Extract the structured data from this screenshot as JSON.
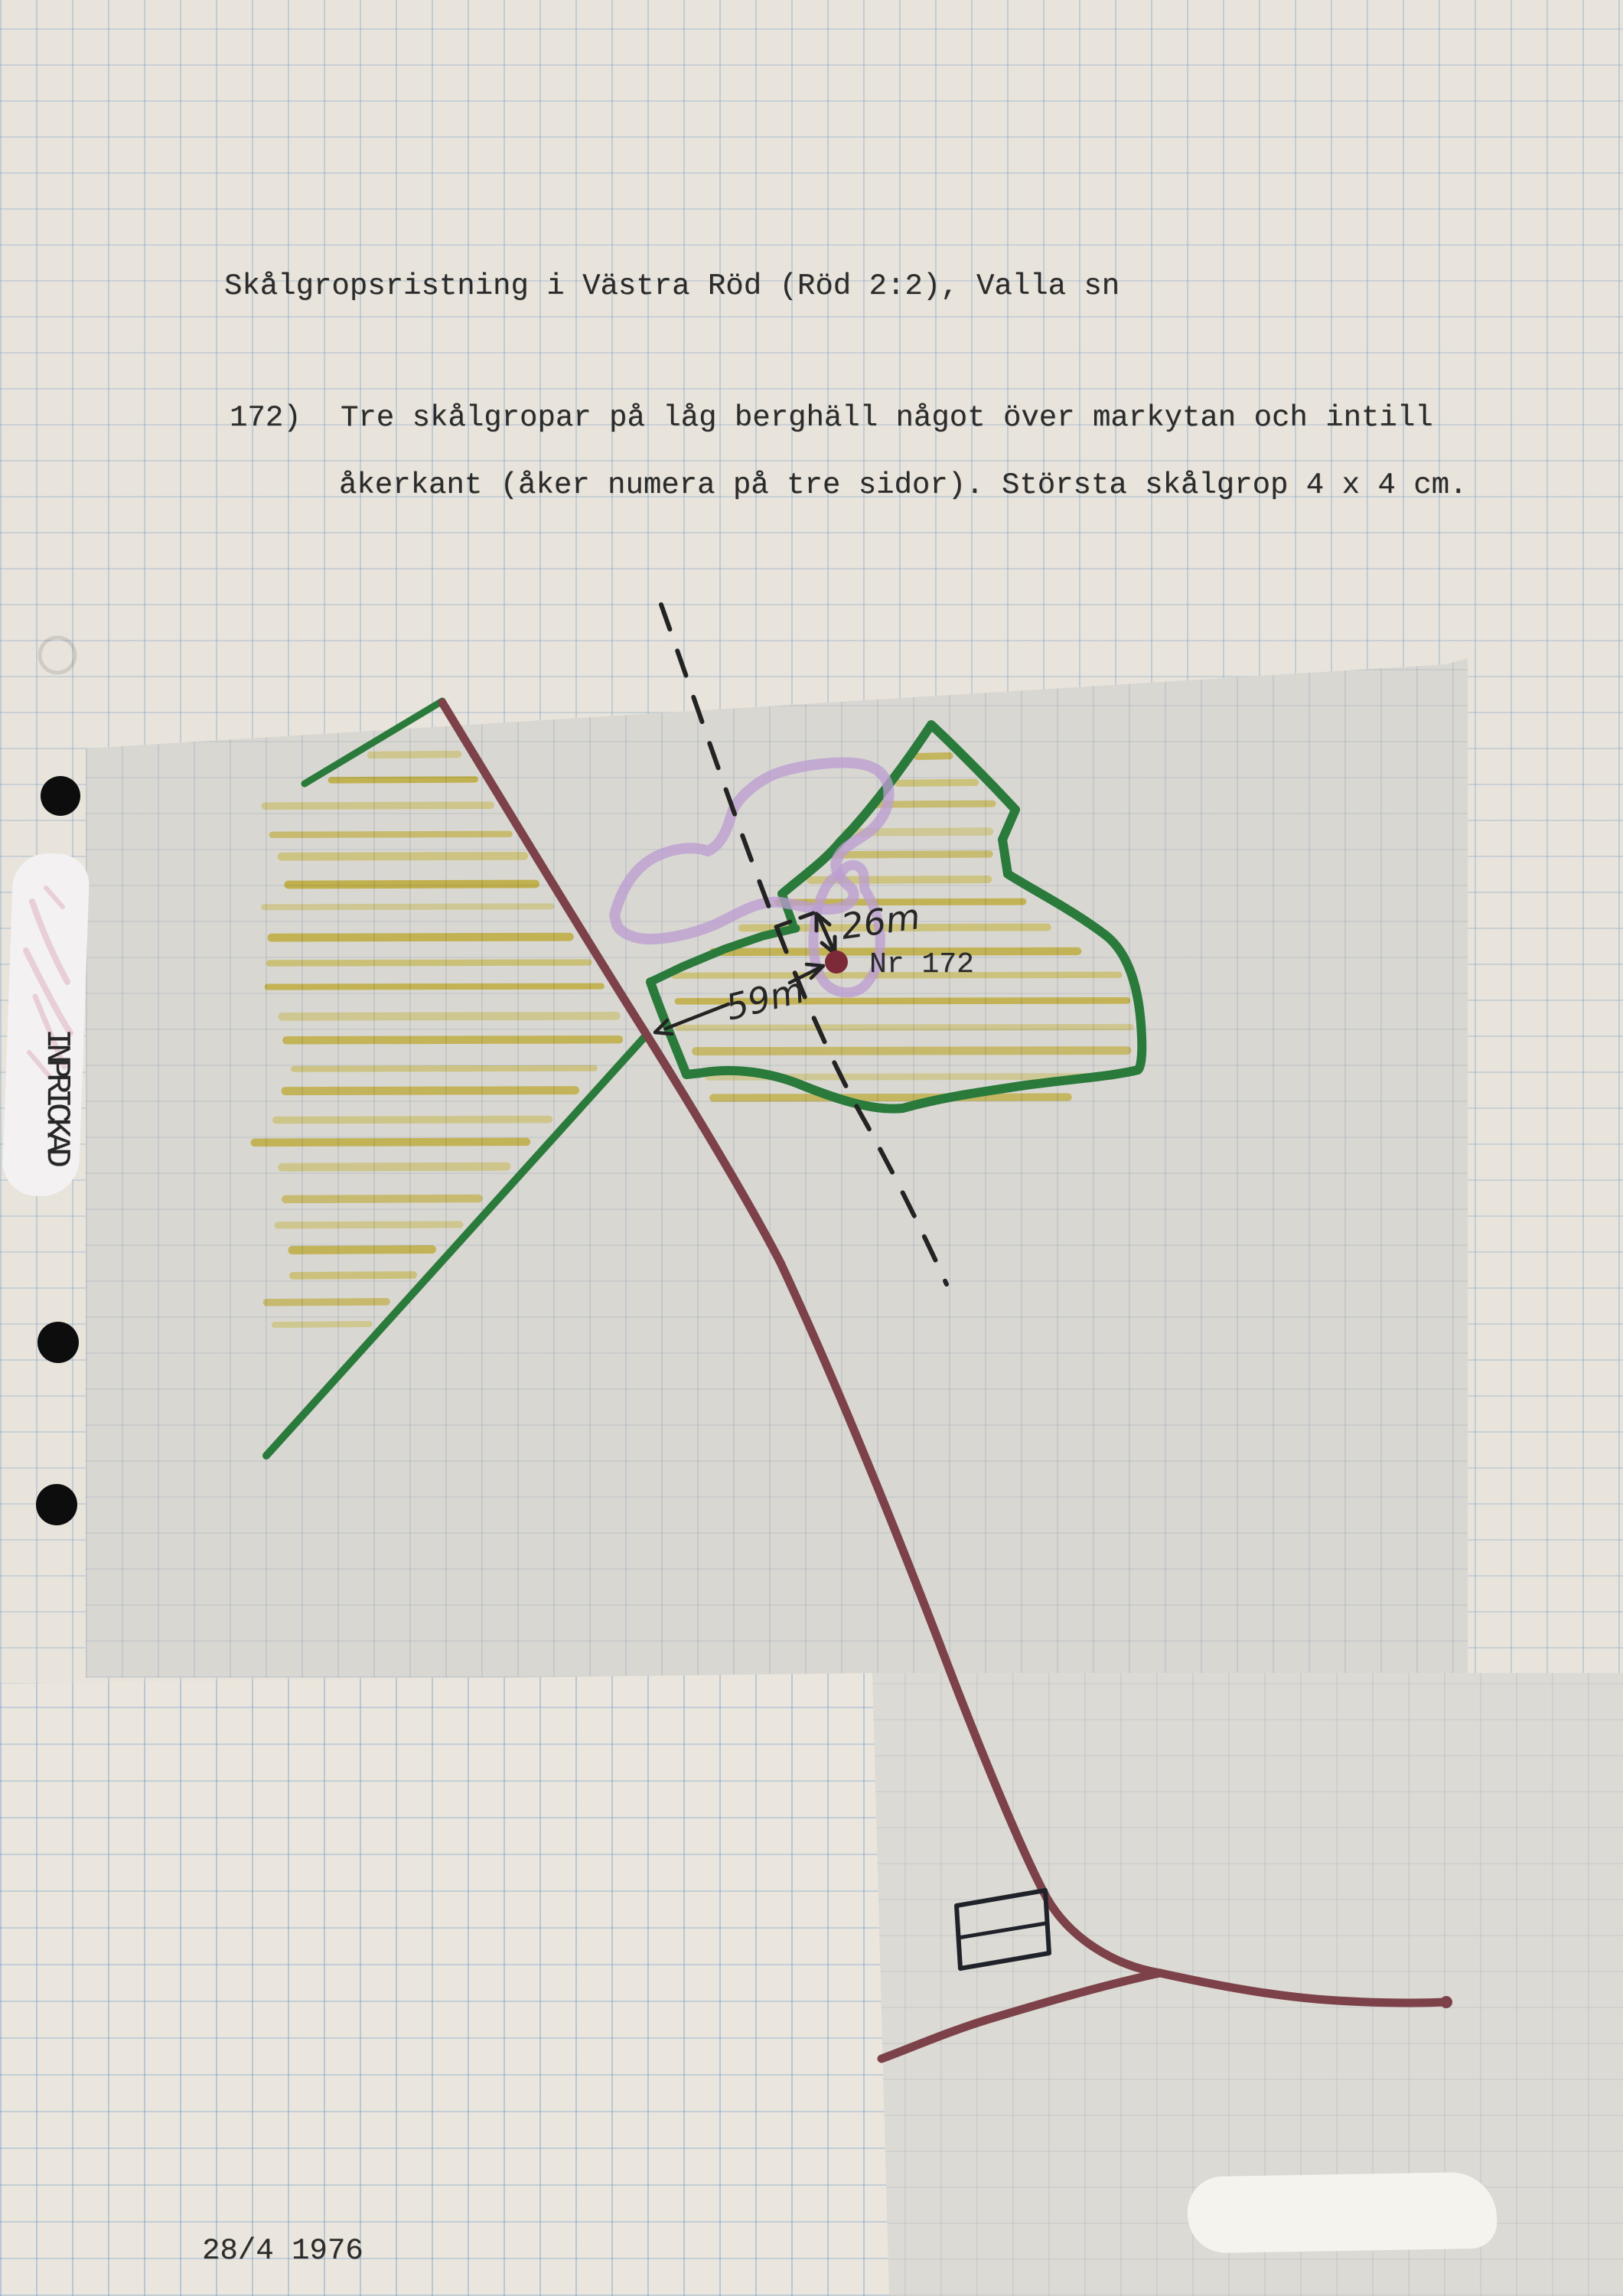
{
  "document": {
    "title": "Skålgropsristning i Västra Röd (Röd 2:2), Valla sn",
    "entry": {
      "number": "172)",
      "description_line1": "Tre skålgropar på låg berghäll något över markytan och intill",
      "description_line2": "åkerkant (åker numera på tre sidor). Största skålgrop 4 x 4 cm."
    },
    "date": "28/4 1976",
    "margin_stamp": "INPRICKAD"
  },
  "map": {
    "site_label": "Nr 172",
    "distance_to_boundary": "26m",
    "distance_to_road": "59m",
    "colors": {
      "road": "#7c4149",
      "field_boundary": "#2a7a3b",
      "field_hatching": "#ddc636",
      "field_hatching_light": "#ecdf7a",
      "rock_outline": "#bb9ed1",
      "site_dot": "#7c2a38",
      "ink": "#232323"
    }
  }
}
